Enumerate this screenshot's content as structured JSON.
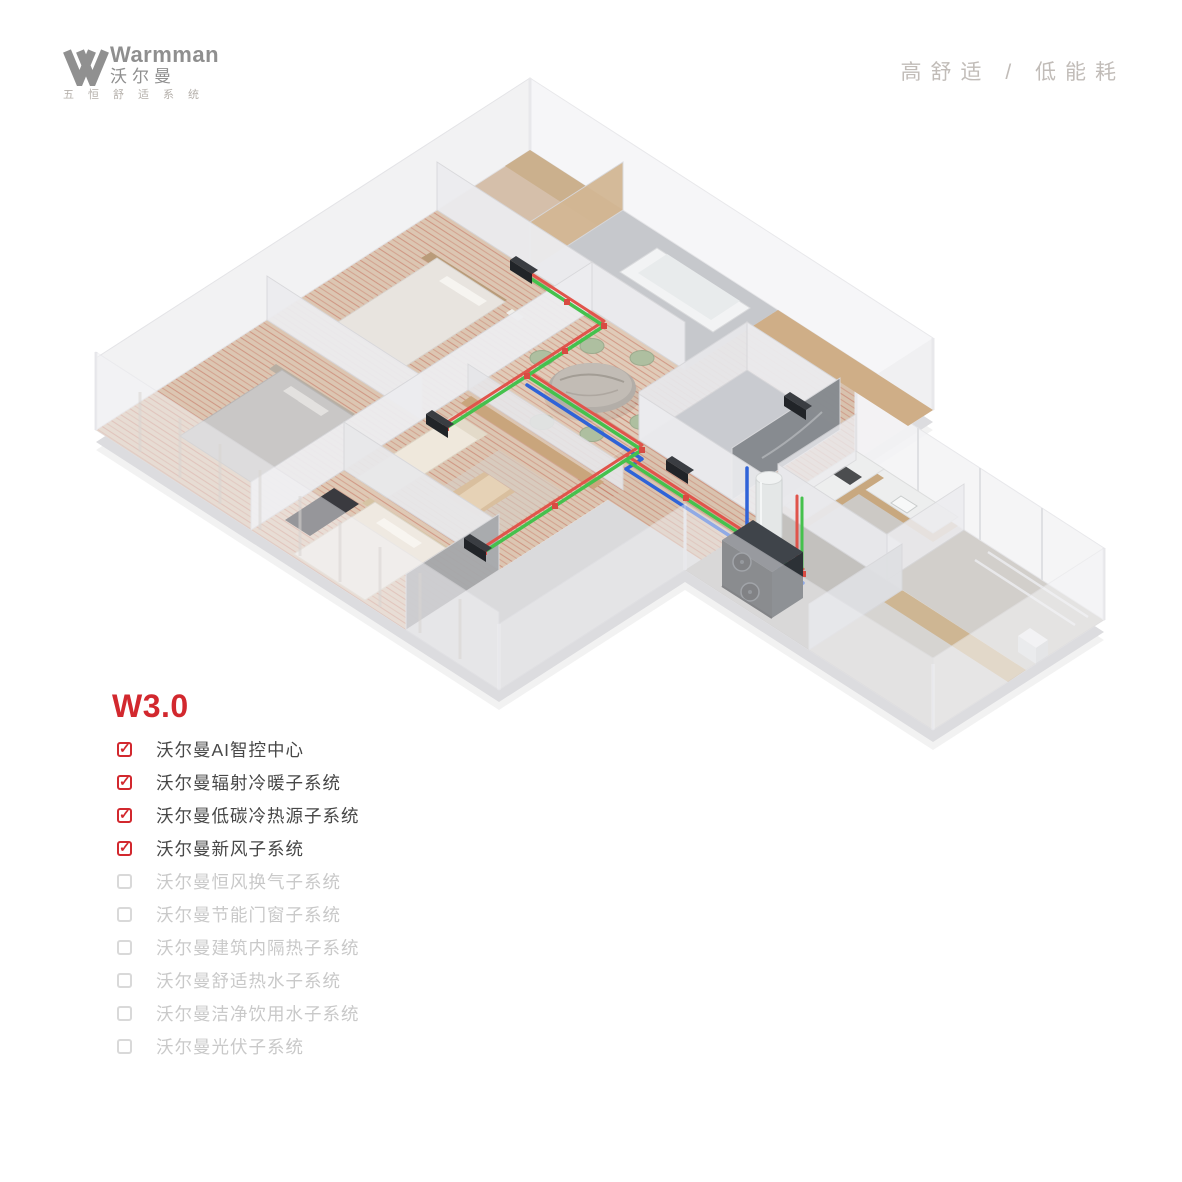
{
  "brand": {
    "name_en": "Warmman",
    "name_cn": "沃尔曼",
    "slogan_cn": "五恒舒适系统",
    "logo_gray": "#8f8f8f"
  },
  "header": {
    "tagline": "高舒适 / 低能耗"
  },
  "panel": {
    "version_title": "W3.0"
  },
  "checklist": {
    "items": [
      {
        "label": "沃尔曼AI智控中心",
        "checked": true
      },
      {
        "label": "沃尔曼辐射冷暖子系统",
        "checked": true
      },
      {
        "label": "沃尔曼低碳冷热源子系统",
        "checked": true
      },
      {
        "label": "沃尔曼新风子系统",
        "checked": true
      },
      {
        "label": "沃尔曼恒风换气子系统",
        "checked": false
      },
      {
        "label": "沃尔曼节能门窗子系统",
        "checked": false
      },
      {
        "label": "沃尔曼建筑内隔热子系统",
        "checked": false
      },
      {
        "label": "沃尔曼舒适热水子系统",
        "checked": false
      },
      {
        "label": "沃尔曼洁净饮用水子系统",
        "checked": false
      },
      {
        "label": "沃尔曼光伏子系统",
        "checked": false
      }
    ]
  },
  "colors": {
    "accent_red": "#d2282e",
    "checked_text": "#474747",
    "unchecked_text": "#c9c9c9",
    "pipe_green": "#45c14d",
    "pipe_red": "#e0544b",
    "pipe_blue": "#2f63d8",
    "floor_heating_coil": "#c4705f",
    "wood_floor": "#dcc6b2"
  }
}
